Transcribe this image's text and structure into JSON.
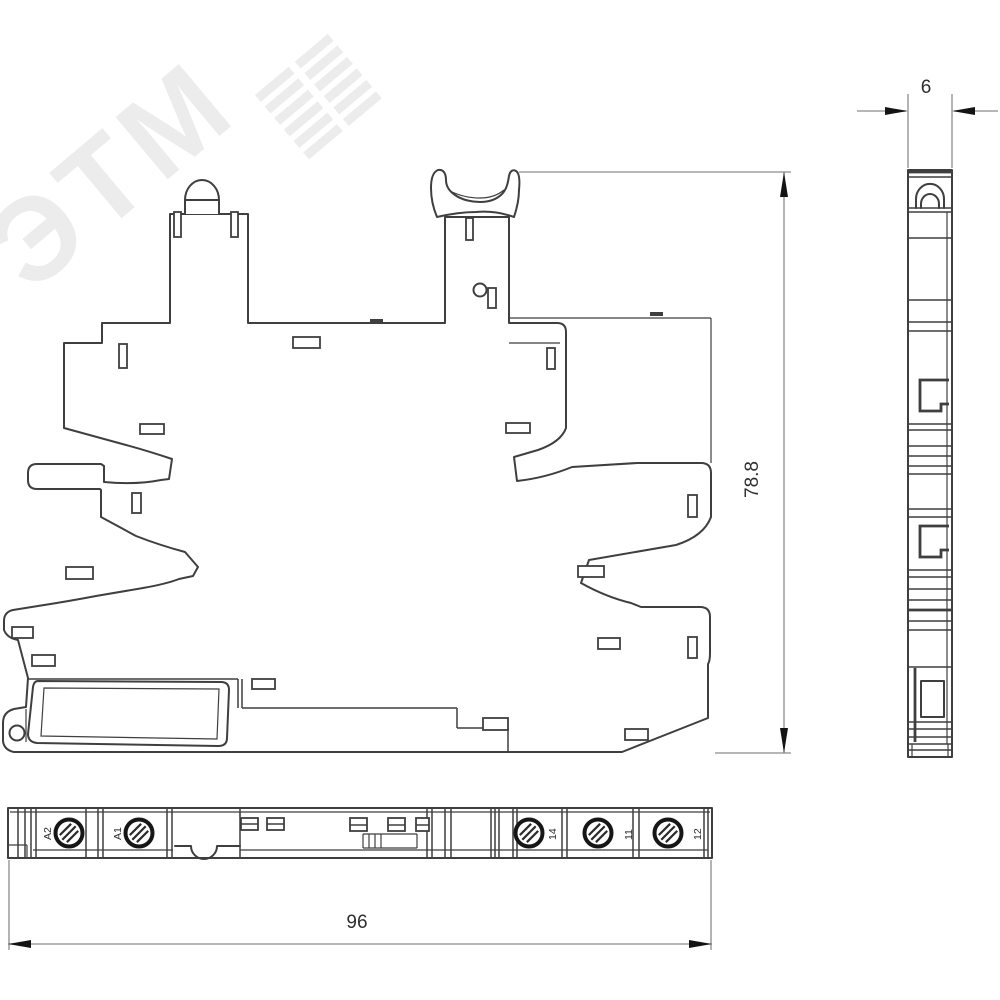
{
  "watermark": {
    "text": "ЭТМ"
  },
  "dimensions": {
    "height_mm": "78.8",
    "depth_mm": "6",
    "width_mm": "96"
  },
  "terminals": {
    "labels": [
      "A2",
      "A1",
      "14",
      "11",
      "12"
    ]
  },
  "colors": {
    "line": "#3f3f3f",
    "dim": "#8c8c8c",
    "arrow": "#141414",
    "text": "#2e2e2e",
    "watermark": "#ececec"
  }
}
